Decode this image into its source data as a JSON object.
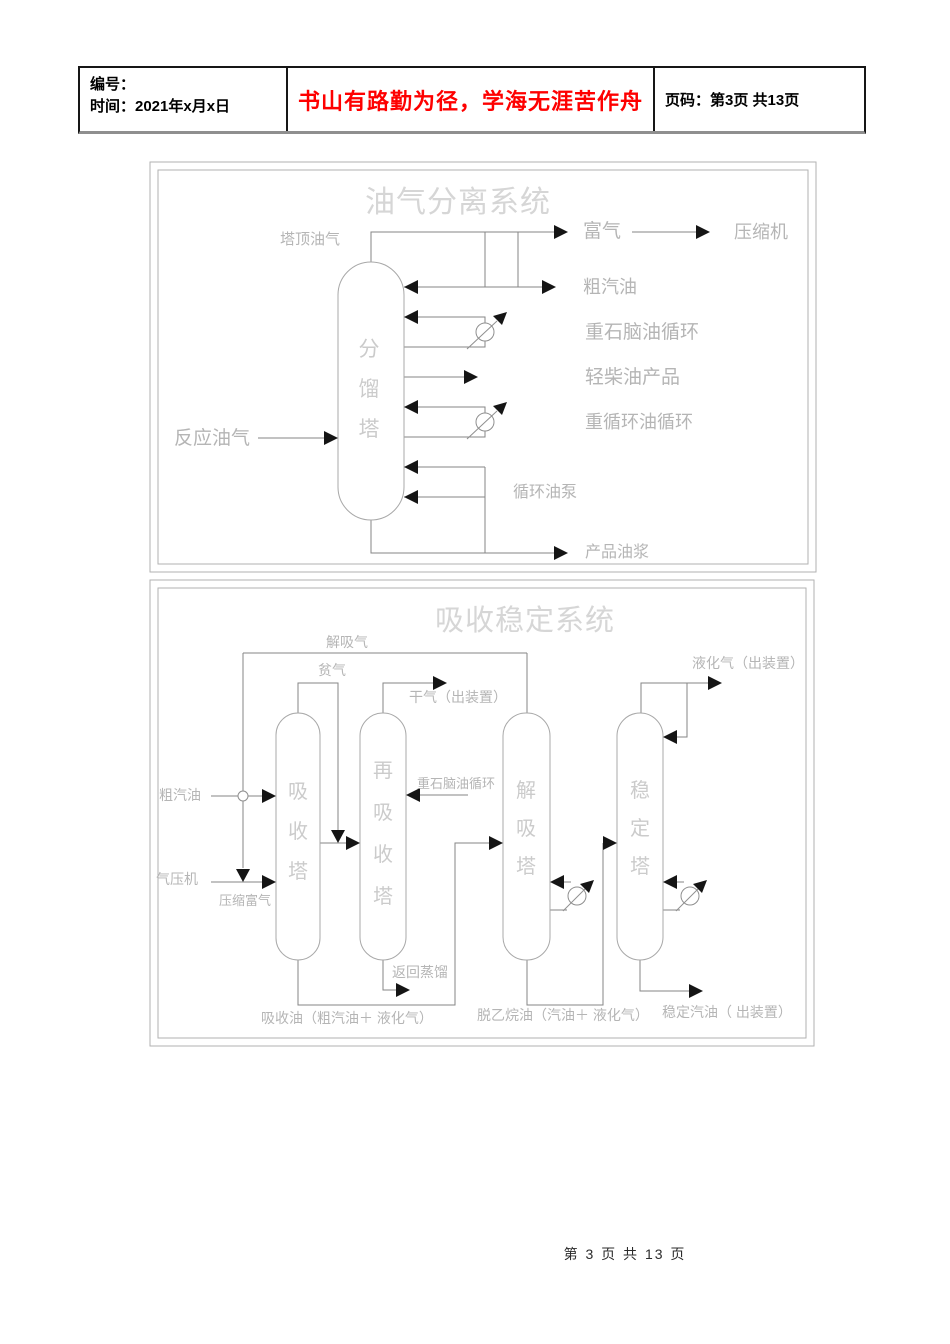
{
  "header": {
    "number_label": "编号：",
    "time_label": "时间：2021年x月x日",
    "slogan": "书山有路勤为径，学海无涯苦作舟",
    "page_info": "页码：第3页 共13页",
    "slogan_color": "#fe0000"
  },
  "footer": {
    "page_info": "第 3 页 共 13 页"
  },
  "colors": {
    "line": "#858585",
    "arrow": "#151515",
    "box_border": "#b2b2b2",
    "label_gray": "#b5b5b5",
    "title_gray": "#d6d6d6"
  },
  "diagram1": {
    "title": "油气分离系统",
    "tower": "分馏塔",
    "labels": {
      "overhead_oil_gas": "塔顶油气",
      "rich_gas": "富气",
      "compressor": "压缩机",
      "crude_gasoline": "粗汽油",
      "heavy_naphtha_cycle": "重石脑油循环",
      "light_diesel_product": "轻柴油产品",
      "heavy_cycle_oil_cycle": "重循环油循环",
      "reaction_oil_gas": "反应油气",
      "cycle_oil_pump": "循环油泵",
      "product_slurry": "产品油浆"
    }
  },
  "diagram2": {
    "title": "吸收稳定系统",
    "towers": {
      "absorber": "吸收塔",
      "reabsorber": "再吸收塔",
      "desorber": "解吸塔",
      "stabilizer": "稳定塔"
    },
    "labels": {
      "desorbed_gas": "解吸气",
      "lean_gas": "贫气",
      "dry_gas": "干气（出装置）",
      "lpg_out": "液化气（出装置）",
      "heavy_naphtha_cycle": "重石脑油循环",
      "crude_gasoline": "粗汽油",
      "gas_compressor": "气压机",
      "compressed_rich_gas": "压缩富气",
      "return_distillation": "返回蒸馏",
      "absorption_oil": "吸收油（粗汽油＋ 液化气）",
      "deethanized_oil": "脱乙烷油（汽油＋ 液化气）",
      "stabilized_gasoline": "稳定汽油（ 出装置）"
    }
  }
}
